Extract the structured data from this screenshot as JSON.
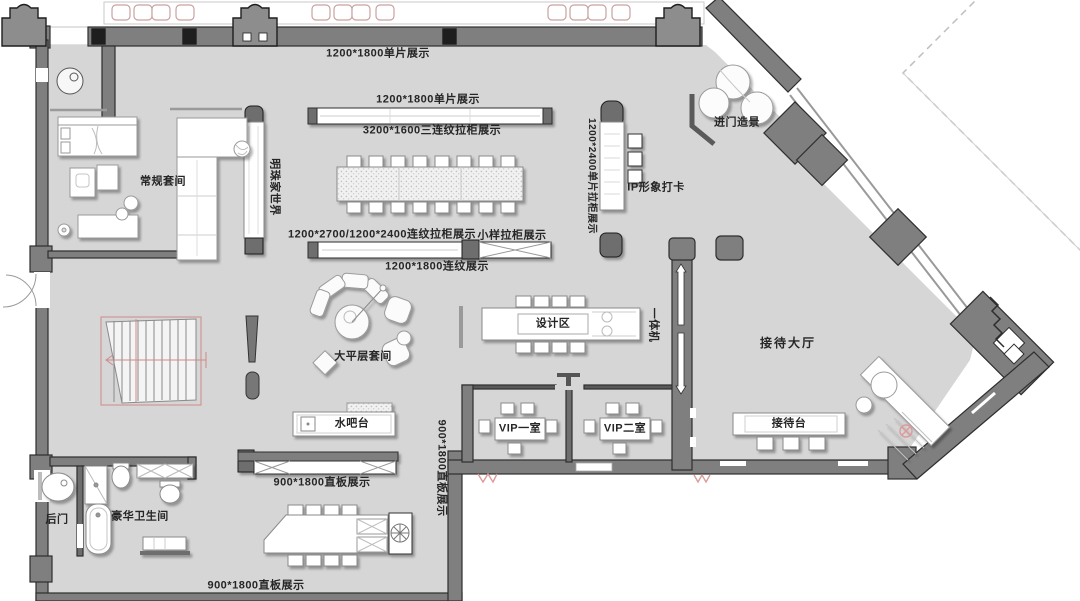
{
  "plan": {
    "displays": {
      "top_single_panel": "1200*1800单片展示",
      "mid_single_panel": "1200*1800单片展示",
      "triple_grain_cabinet": "3200*1600三连纹拉柜展示",
      "combo_grain_cabinet": "1200*2700/1200*2400连纹拉柜展示",
      "sample_cabinet": "小样拉柜展示",
      "grain_display": "1200*1800连纹展示",
      "single_panel_cabinet": "1200*2400单片拉柜展示",
      "straight_board_mid": "900*1800直板展示",
      "straight_board_side": "900*1800直板展示",
      "straight_board_bottom": "900*1800直板展示"
    },
    "rooms": {
      "regular_suite": "常规套间",
      "penthouse_suite": "大平层套间",
      "design_area": "设计区",
      "reception_hall": "接待大厅",
      "vip_room_1": "VIP一室",
      "vip_room_2": "VIP二室",
      "luxury_bathroom": "豪华卫生间"
    },
    "features": {
      "pearl_home_world": "明珠家世界",
      "ip_photo_checkin": "IP形象打卡",
      "entrance_scene": "进门造景",
      "all_in_one_machine": "一体机",
      "water_bar": "水吧台",
      "reception_desk": "接待台",
      "back_door": "后门"
    },
    "colors": {
      "floor": "#d6d6d6",
      "wall": "#7f7f7f",
      "accent_red": "#c97f7f"
    }
  }
}
